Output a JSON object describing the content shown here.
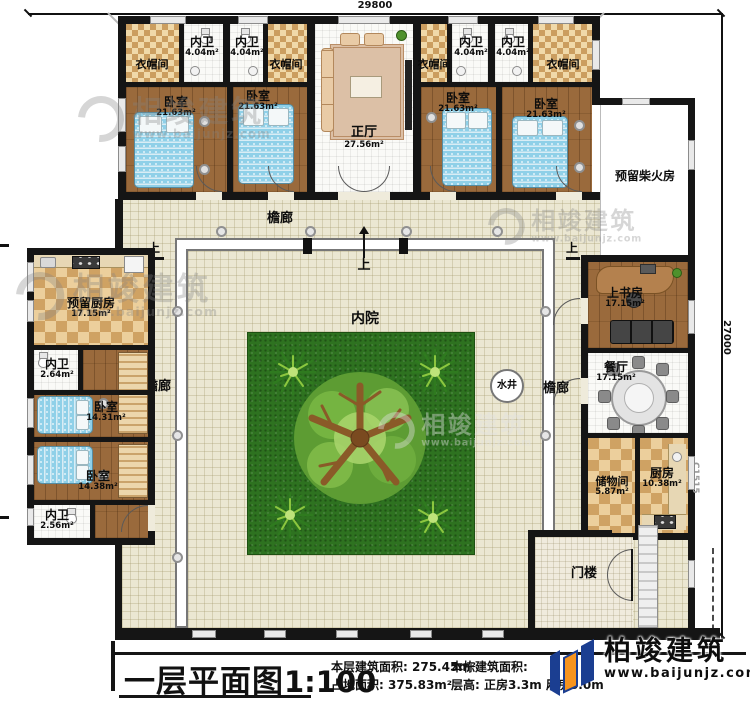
{
  "colors": {
    "logo_blue": "#1b3e91",
    "logo_orange": "#f7941e",
    "lawn_green": "#2e7220",
    "wall_black": "#151515",
    "paving_beige": "#ebe7d2",
    "wood_brown": "#9a6a3c"
  },
  "dimensions": {
    "top_width": "29800",
    "right_height": "27000",
    "window_code": "C1515"
  },
  "watermark": {
    "brand": "相竣建筑",
    "url": "www.baijunjz.com"
  },
  "logo": {
    "brand": "柏竣建筑",
    "url": "www.baijunjz.com"
  },
  "labels": {
    "cloakroom": "衣帽间",
    "inner_bath": "内卫",
    "bedroom": "卧室",
    "main_hall": "正厅",
    "corridor": "檐廊",
    "courtyard": "内院",
    "well": "水井",
    "gatehouse": "门楼",
    "up": "上",
    "firewood_room": "预留柴火房",
    "reserved_kitchen": "预留厨房",
    "study": "上书房",
    "dining": "餐厅",
    "storage": "储物间",
    "kitchen": "厨房"
  },
  "areas": {
    "inner_bath_north": "4.04m²",
    "bedroom_north": "21.63m²",
    "main_hall": "27.56m²",
    "reserved_kitchen": "17.15m²",
    "inner_bath_west1": "2.64m²",
    "bedroom_west1": "14.31m²",
    "bedroom_west2": "14.38m²",
    "inner_bath_west2": "2.56m²",
    "study": "17.15m²",
    "dining": "17.15m²",
    "storage": "5.87m²",
    "kitchen": "10.38m²"
  },
  "title_block": {
    "plan_title": "一层平面图",
    "scale": "1:100",
    "floor_area_label": "本层建筑面积:",
    "floor_area_value": "275.45m²",
    "site_area_label": "占地面积:",
    "site_area_value": "375.83m²",
    "building_area_label": "本栋建筑面积:",
    "height_label": "层高:",
    "height_value": "正房3.3m 厢房3.0m"
  }
}
